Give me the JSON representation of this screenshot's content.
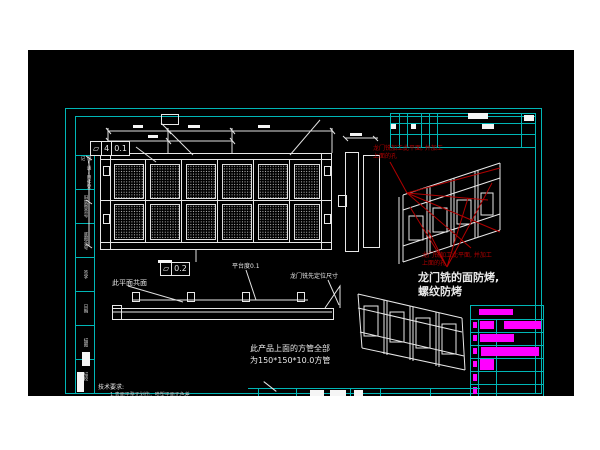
{
  "colors": {
    "cyan": "#00b6b6",
    "magenta": "#ff00ff",
    "red": "#b00000",
    "line": "#e8e8e8"
  },
  "gdt_flatness_main": {
    "symbol": "⏥",
    "datum": "4",
    "tolerance": "0.1"
  },
  "gdt_flatness_platform": {
    "symbol": "⏥",
    "tolerance": "0.2"
  },
  "annotations": {
    "coplanar": "此平面共面",
    "platform_flatness": "平台度0.1",
    "gantry_locating": "龙门铣先定位尺寸",
    "red_machining_l1": "龙门铣加工此平面, 并加工",
    "red_machining_l2": "上面的孔",
    "protect_l1": "龙门铣的面防烤,",
    "protect_l2": "螺纹防烤",
    "tube_l1": "此产品上面的方管全部",
    "tube_l2": "为150*150*10.0方管",
    "tech_title": "技术要求:",
    "tech_item": "1.表面平整无划伤，喷塑平面无色差"
  },
  "left_strip": [
    "借(通)用件登记",
    "旧底图总号",
    "底图总号",
    "签字",
    "日期",
    "描图",
    "描校"
  ]
}
